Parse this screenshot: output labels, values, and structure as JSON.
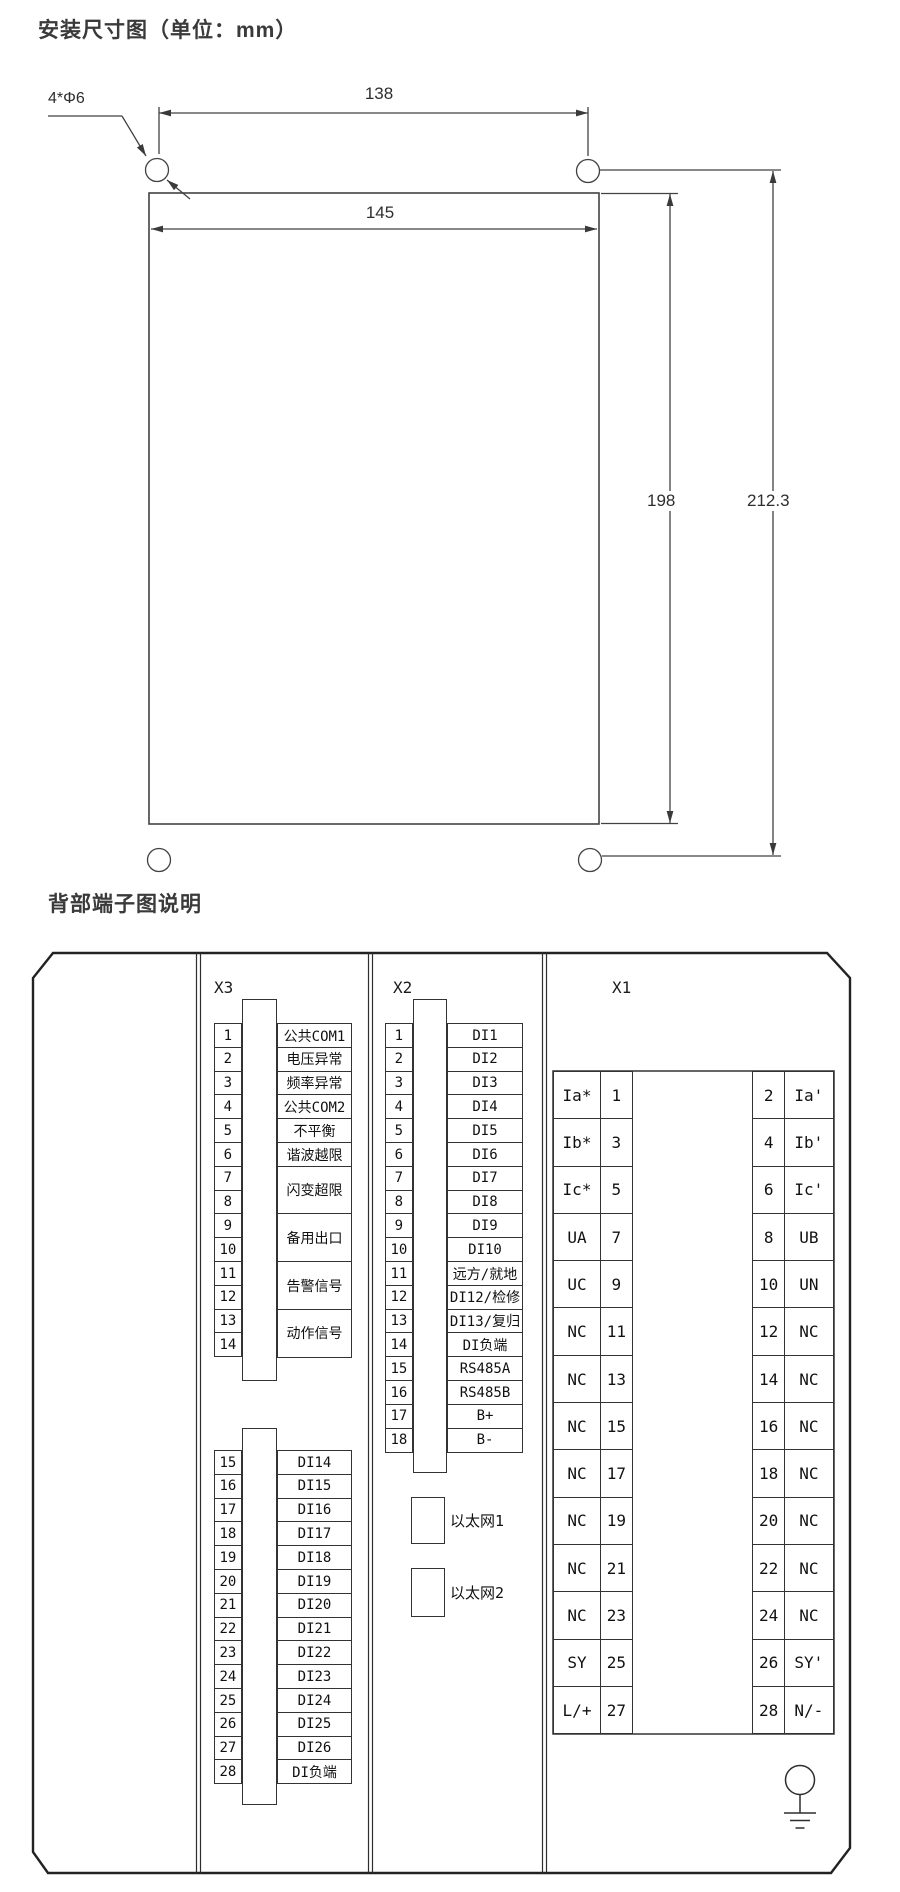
{
  "titles": {
    "dimension": "安装尺寸图（单位：mm）",
    "terminal": "背部端子图说明"
  },
  "dimension_figure": {
    "width_top": "138",
    "width_panel": "145",
    "height_inner": "198",
    "height_outer": "212.3",
    "holes_note": "4*Φ6"
  },
  "x3": {
    "header": "X3",
    "upper_numbers": [
      "1",
      "2",
      "3",
      "4",
      "5",
      "6",
      "7",
      "8",
      "9",
      "10",
      "11",
      "12",
      "13",
      "14"
    ],
    "upper_labels_single": [
      "公共COM1",
      "电压异常",
      "频率异常",
      "公共COM2",
      "不平衡",
      "谐波越限"
    ],
    "upper_labels_double": [
      "闪变超限",
      "备用出口",
      "告警信号",
      "动作信号"
    ],
    "lower_numbers": [
      "15",
      "16",
      "17",
      "18",
      "19",
      "20",
      "21",
      "22",
      "23",
      "24",
      "25",
      "26",
      "27",
      "28"
    ],
    "lower_labels": [
      "DI14",
      "DI15",
      "DI16",
      "DI17",
      "DI18",
      "DI19",
      "DI20",
      "DI21",
      "DI22",
      "DI23",
      "DI24",
      "DI25",
      "DI26",
      "DI负端"
    ]
  },
  "x2": {
    "header": "X2",
    "numbers": [
      "1",
      "2",
      "3",
      "4",
      "5",
      "6",
      "7",
      "8",
      "9",
      "10",
      "11",
      "12",
      "13",
      "14",
      "15",
      "16",
      "17",
      "18"
    ],
    "labels": [
      "DI1",
      "DI2",
      "DI3",
      "DI4",
      "DI5",
      "DI6",
      "DI7",
      "DI8",
      "DI9",
      "DI10",
      "远方/就地",
      "DI12/检修",
      "DI13/复归",
      "DI负端",
      "RS485A",
      "RS485B",
      "B+",
      "B-"
    ],
    "ethernet": [
      "以太网1",
      "以太网2"
    ]
  },
  "x1": {
    "header": "X1",
    "rows": [
      {
        "l_label": "Ia*",
        "l_num": "1",
        "r_num": "2",
        "r_label": "Ia'"
      },
      {
        "l_label": "Ib*",
        "l_num": "3",
        "r_num": "4",
        "r_label": "Ib'"
      },
      {
        "l_label": "Ic*",
        "l_num": "5",
        "r_num": "6",
        "r_label": "Ic'"
      },
      {
        "l_label": "UA",
        "l_num": "7",
        "r_num": "8",
        "r_label": "UB"
      },
      {
        "l_label": "UC",
        "l_num": "9",
        "r_num": "10",
        "r_label": "UN"
      },
      {
        "l_label": "NC",
        "l_num": "11",
        "r_num": "12",
        "r_label": "NC"
      },
      {
        "l_label": "NC",
        "l_num": "13",
        "r_num": "14",
        "r_label": "NC"
      },
      {
        "l_label": "NC",
        "l_num": "15",
        "r_num": "16",
        "r_label": "NC"
      },
      {
        "l_label": "NC",
        "l_num": "17",
        "r_num": "18",
        "r_label": "NC"
      },
      {
        "l_label": "NC",
        "l_num": "19",
        "r_num": "20",
        "r_label": "NC"
      },
      {
        "l_label": "NC",
        "l_num": "21",
        "r_num": "22",
        "r_label": "NC"
      },
      {
        "l_label": "NC",
        "l_num": "23",
        "r_num": "24",
        "r_label": "NC"
      },
      {
        "l_label": "SY",
        "l_num": "25",
        "r_num": "26",
        "r_label": "SY'"
      },
      {
        "l_label": "L/+",
        "l_num": "27",
        "r_num": "28",
        "r_label": "N/-"
      }
    ]
  },
  "colors": {
    "line": "#3a3a3a",
    "panel_line": "#222222",
    "text": "#111111"
  }
}
